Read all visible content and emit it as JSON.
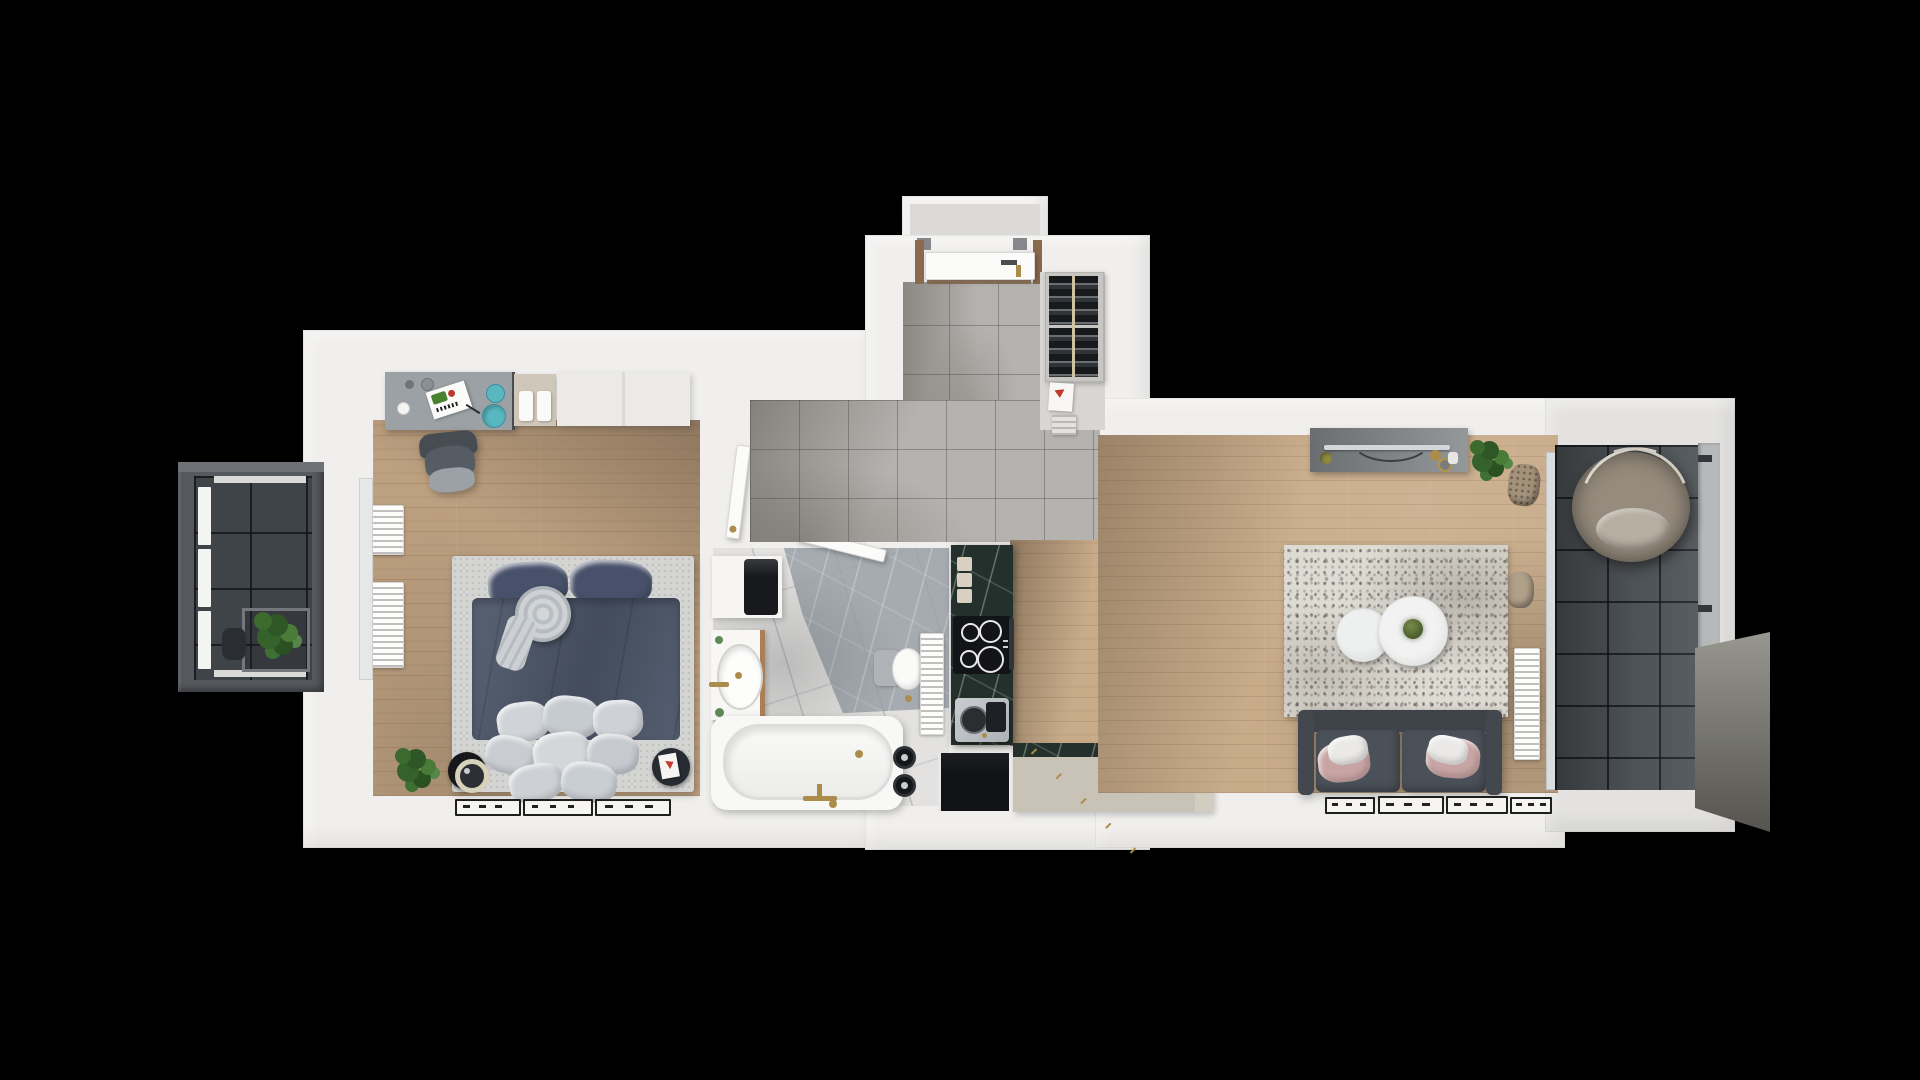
{
  "scene": {
    "type": "3d-apartment-floor-plan-top-view",
    "background": "#000000",
    "canvas_width": 1920,
    "canvas_height": 1080
  },
  "palette": {
    "wall": "#f0efed",
    "wall_shade": "#e3e2e0",
    "wood_bedroom": "#bda080",
    "wood_living": "#c8ab89",
    "tile_hall": "#b5b3af",
    "tile_balcony_left": "#3f4448",
    "tile_balcony_right": "#4d5256",
    "marble_bath_light": "#e3e2e0",
    "marble_bath_dark": "#9aa1a8",
    "marble_counter": "#24302b",
    "island_beige": "#c9c2b6",
    "island_dark": "#101215",
    "bed_frame": "#d4d5d3",
    "bed_duvet": "#4c5669",
    "bed_pillow": "#47516a",
    "blanket": "#c8cdd1",
    "sofa": "#4b5158",
    "cushion_pink": "#c9a4a4",
    "cushion_white": "#eae9e7",
    "rug": "#dedbd4",
    "table_wood": "#c4a17d",
    "chair_seat": "#868b8f",
    "chair_back": "#d7d2c8",
    "desk": "#9ba1a5",
    "wardrobe": "#ebeae8",
    "accent_gold": "#ab8c4a",
    "accent_teal": "#58b8c2",
    "plant_green": "#3c6a2f",
    "door_wood": "#8a6a4c",
    "cooktop": "#131417",
    "appliance_dark": "#17191d",
    "rattan": "#a3917a"
  },
  "rooms": [
    {
      "id": "bedroom",
      "floor": "oak-wood"
    },
    {
      "id": "bathroom",
      "floor": "marble"
    },
    {
      "id": "entrance-hall",
      "floor": "gray-ceramic-tile"
    },
    {
      "id": "kitchen",
      "floor": "oak-wood"
    },
    {
      "id": "dining-area",
      "floor": "oak-wood"
    },
    {
      "id": "living-room",
      "floor": "oak-wood"
    },
    {
      "id": "balcony-left",
      "floor": "dark-tile"
    },
    {
      "id": "balcony-right",
      "floor": "dark-tile"
    }
  ],
  "furniture": {
    "bedroom": [
      "desk",
      "desk-chair",
      "drawer-unit",
      "wardrobe",
      "double-bed",
      "bench-pillows",
      "wall-radiators",
      "floor-speaker",
      "side-table",
      "potted-plant",
      "picture-frames"
    ],
    "bathroom": [
      "washer-cabinet",
      "washbasin",
      "toilet",
      "towel-radiator",
      "bathtub",
      "black-stools"
    ],
    "entrance-hall": [
      "entrance-door",
      "shoe-cabinet",
      "dropped-papers",
      "step-stool"
    ],
    "kitchen": [
      "marble-counter",
      "cutting-boards",
      "induction-cooktop",
      "coffee-machine",
      "dark-base-cabinet",
      "kitchen-island"
    ],
    "dining-area": [
      "dining-table",
      "dining-chairs",
      "placemats",
      "centerpiece"
    ],
    "living-room": [
      "tv-sideboard",
      "tv",
      "decor-plant",
      "wicker-baskets",
      "area-rug",
      "coffee-tables",
      "sofa",
      "cushions",
      "wall-radiator",
      "picture-frames"
    ],
    "balcony-left": [
      "glass-railing",
      "planter-box",
      "watering-can"
    ],
    "balcony-right": [
      "hanging-egg-chair",
      "railing"
    ]
  },
  "counts": {
    "cooktop_burners": 4,
    "dining_chairs": 4,
    "placemats": 4,
    "bench_pillows": 8,
    "sofa_cushions": 4,
    "picture_frames_bedroom": 3,
    "picture_frames_living": 4,
    "glass_railing_panels": 3,
    "cutting_boards": 3
  }
}
